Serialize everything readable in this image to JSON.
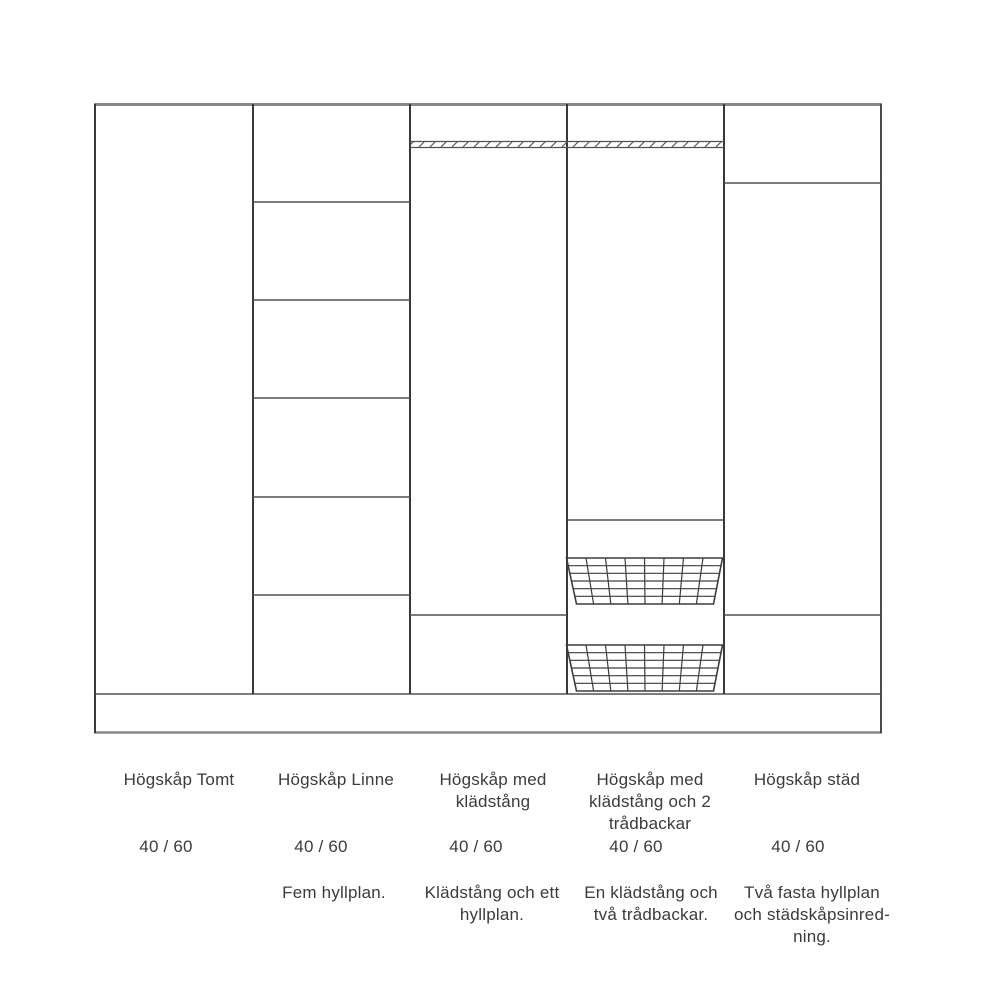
{
  "page": {
    "background": "#ffffff"
  },
  "diagram": {
    "type": "wardrobe-cabinet-lineup",
    "colors": {
      "outer_frame": "#87888b",
      "vertical_lines": "#39393b",
      "shelf_lines": "#505153",
      "basket_lines": "#3c3d3f",
      "text": "#3a3b3d"
    },
    "cabinets": [
      {
        "name": "Högskåp Tomt",
        "size": "40 / 60",
        "description": ""
      },
      {
        "name": "Högskåp Linne",
        "size": "40 / 60",
        "description": "Fem hyllplan."
      },
      {
        "name": "Högskåp med\nklädstång",
        "size": "40 / 60",
        "description": "Klädstång och ett\nhyllplan."
      },
      {
        "name": "Högskåp med\nklädstång och 2\ntrådbackar",
        "size": "40 / 60",
        "description": "En klädstång och\ntvå trådbackar."
      },
      {
        "name": "Högskåp städ",
        "size": "40 / 60",
        "description": "Två fasta hyllplan\noch städskåpsinred-\nning."
      }
    ]
  }
}
